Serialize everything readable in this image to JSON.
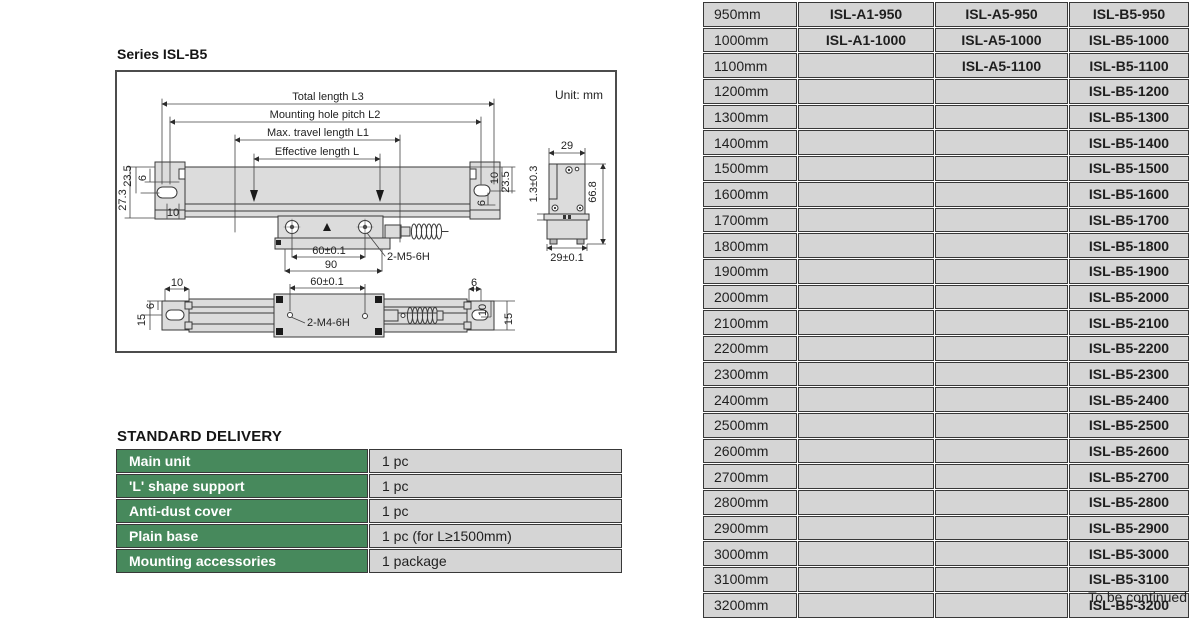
{
  "colors": {
    "accent_green": "#47895c",
    "cell_gray": "#d5d5d5",
    "line_dark": "#3a3a3a",
    "metal_fill": "#dcdcdc"
  },
  "header": {
    "series_title": "Series ISL-B5",
    "unit_note": "Unit: mm"
  },
  "diagram": {
    "side": {
      "l3": "Total length L3",
      "l2": "Mounting hole pitch L2",
      "l1": "Max. travel length L1",
      "l": "Effective length L",
      "left_23_5": "23.5",
      "left_6": "6",
      "left_27_3": "27.3",
      "left_10": "10",
      "right_10": "10",
      "right_23_5": "23.5",
      "right_6": "6",
      "dim_60": "60±0.1",
      "dim_90": "90",
      "thread": "2-M5-6H"
    },
    "end": {
      "width": "29",
      "gap": "1.3±0.3",
      "height": "66.8",
      "base_width": "29±0.1"
    },
    "top": {
      "dim_60": "60±0.1",
      "thread": "2-M4-6H",
      "left_10": "10",
      "left_6": "6",
      "left_15": "15",
      "right_6": "6",
      "right_10": "10",
      "right_15": "15"
    }
  },
  "standard_delivery": {
    "title": "STANDARD DELIVERY",
    "rows": [
      {
        "item": "Main unit",
        "qty": "1 pc"
      },
      {
        "item": "'L' shape support",
        "qty": "1 pc"
      },
      {
        "item": "Anti-dust cover",
        "qty": "1 pc"
      },
      {
        "item": "Plain base",
        "qty": "1 pc (for L≥1500mm)"
      },
      {
        "item": "Mounting accessories",
        "qty": "1 package"
      }
    ]
  },
  "model_table": {
    "rows": [
      {
        "length": "950mm",
        "a1": "ISL-A1-950",
        "a5": "ISL-A5-950",
        "b5": "ISL-B5-950"
      },
      {
        "length": "1000mm",
        "a1": "ISL-A1-1000",
        "a5": "ISL-A5-1000",
        "b5": "ISL-B5-1000"
      },
      {
        "length": "1100mm",
        "a1": "",
        "a5": "ISL-A5-1100",
        "b5": "ISL-B5-1100"
      },
      {
        "length": "1200mm",
        "a1": "",
        "a5": "",
        "b5": "ISL-B5-1200"
      },
      {
        "length": "1300mm",
        "a1": "",
        "a5": "",
        "b5": "ISL-B5-1300"
      },
      {
        "length": "1400mm",
        "a1": "",
        "a5": "",
        "b5": "ISL-B5-1400"
      },
      {
        "length": "1500mm",
        "a1": "",
        "a5": "",
        "b5": "ISL-B5-1500"
      },
      {
        "length": "1600mm",
        "a1": "",
        "a5": "",
        "b5": "ISL-B5-1600"
      },
      {
        "length": "1700mm",
        "a1": "",
        "a5": "",
        "b5": "ISL-B5-1700"
      },
      {
        "length": "1800mm",
        "a1": "",
        "a5": "",
        "b5": "ISL-B5-1800"
      },
      {
        "length": "1900mm",
        "a1": "",
        "a5": "",
        "b5": "ISL-B5-1900"
      },
      {
        "length": "2000mm",
        "a1": "",
        "a5": "",
        "b5": "ISL-B5-2000"
      },
      {
        "length": "2100mm",
        "a1": "",
        "a5": "",
        "b5": "ISL-B5-2100"
      },
      {
        "length": "2200mm",
        "a1": "",
        "a5": "",
        "b5": "ISL-B5-2200"
      },
      {
        "length": "2300mm",
        "a1": "",
        "a5": "",
        "b5": "ISL-B5-2300"
      },
      {
        "length": "2400mm",
        "a1": "",
        "a5": "",
        "b5": "ISL-B5-2400"
      },
      {
        "length": "2500mm",
        "a1": "",
        "a5": "",
        "b5": "ISL-B5-2500"
      },
      {
        "length": "2600mm",
        "a1": "",
        "a5": "",
        "b5": "ISL-B5-2600"
      },
      {
        "length": "2700mm",
        "a1": "",
        "a5": "",
        "b5": "ISL-B5-2700"
      },
      {
        "length": "2800mm",
        "a1": "",
        "a5": "",
        "b5": "ISL-B5-2800"
      },
      {
        "length": "2900mm",
        "a1": "",
        "a5": "",
        "b5": "ISL-B5-2900"
      },
      {
        "length": "3000mm",
        "a1": "",
        "a5": "",
        "b5": "ISL-B5-3000"
      },
      {
        "length": "3100mm",
        "a1": "",
        "a5": "",
        "b5": "ISL-B5-3100"
      },
      {
        "length": "3200mm",
        "a1": "",
        "a5": "",
        "b5": "ISL-B5-3200"
      }
    ]
  },
  "footer": {
    "continued": "To be continued"
  }
}
